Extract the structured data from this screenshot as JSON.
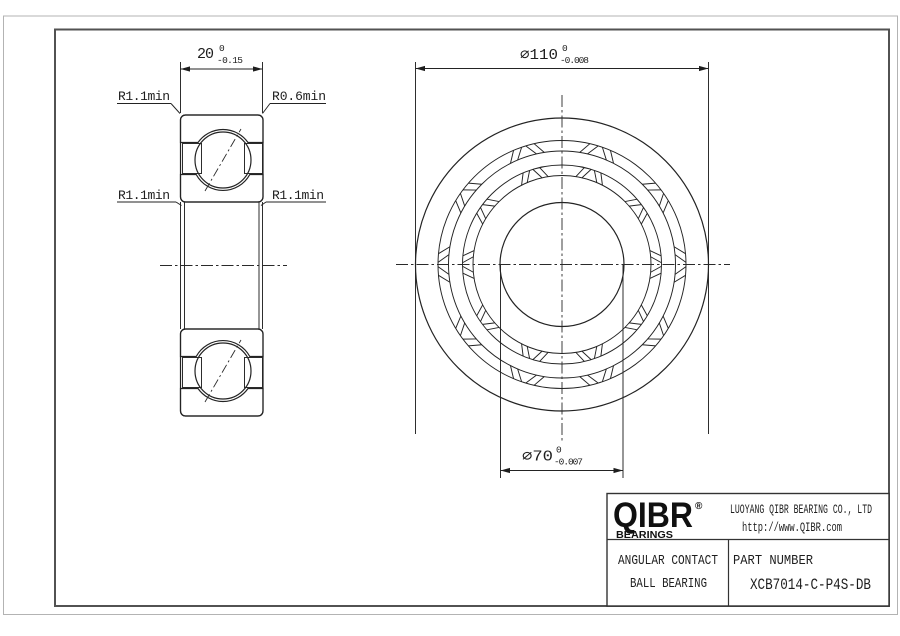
{
  "drawing": {
    "dims": {
      "width": {
        "main": "20",
        "sup": "0",
        "sub": "-0.15"
      },
      "od": {
        "main": "∅110",
        "sup": "0",
        "sub": "-0.008"
      },
      "bore": {
        "main": "∅70",
        "sup": "0",
        "sub": "-0.007"
      }
    },
    "labels": {
      "top_left": "R1.1min",
      "top_right": "R0.6min",
      "mid_left": "R1.1min",
      "mid_right": "R1.1min"
    }
  },
  "title_block": {
    "logo": {
      "name": "QIBR",
      "reg": "®",
      "tagline": "BEARINGS"
    },
    "company": "LUOYANG QIBR BEARING CO., LTD",
    "website": "http://www.QIBR.com",
    "product_line1": "ANGULAR CONTACT",
    "product_line2": "BALL BEARING",
    "part_label": "PART NUMBER",
    "part_number": "XCB7014-C-P4S-DB"
  },
  "colors": {
    "line": "#232323",
    "frame": "#525252",
    "hatch": "#383838",
    "page_border": "#b3b3b3",
    "background": "#ffffff"
  }
}
